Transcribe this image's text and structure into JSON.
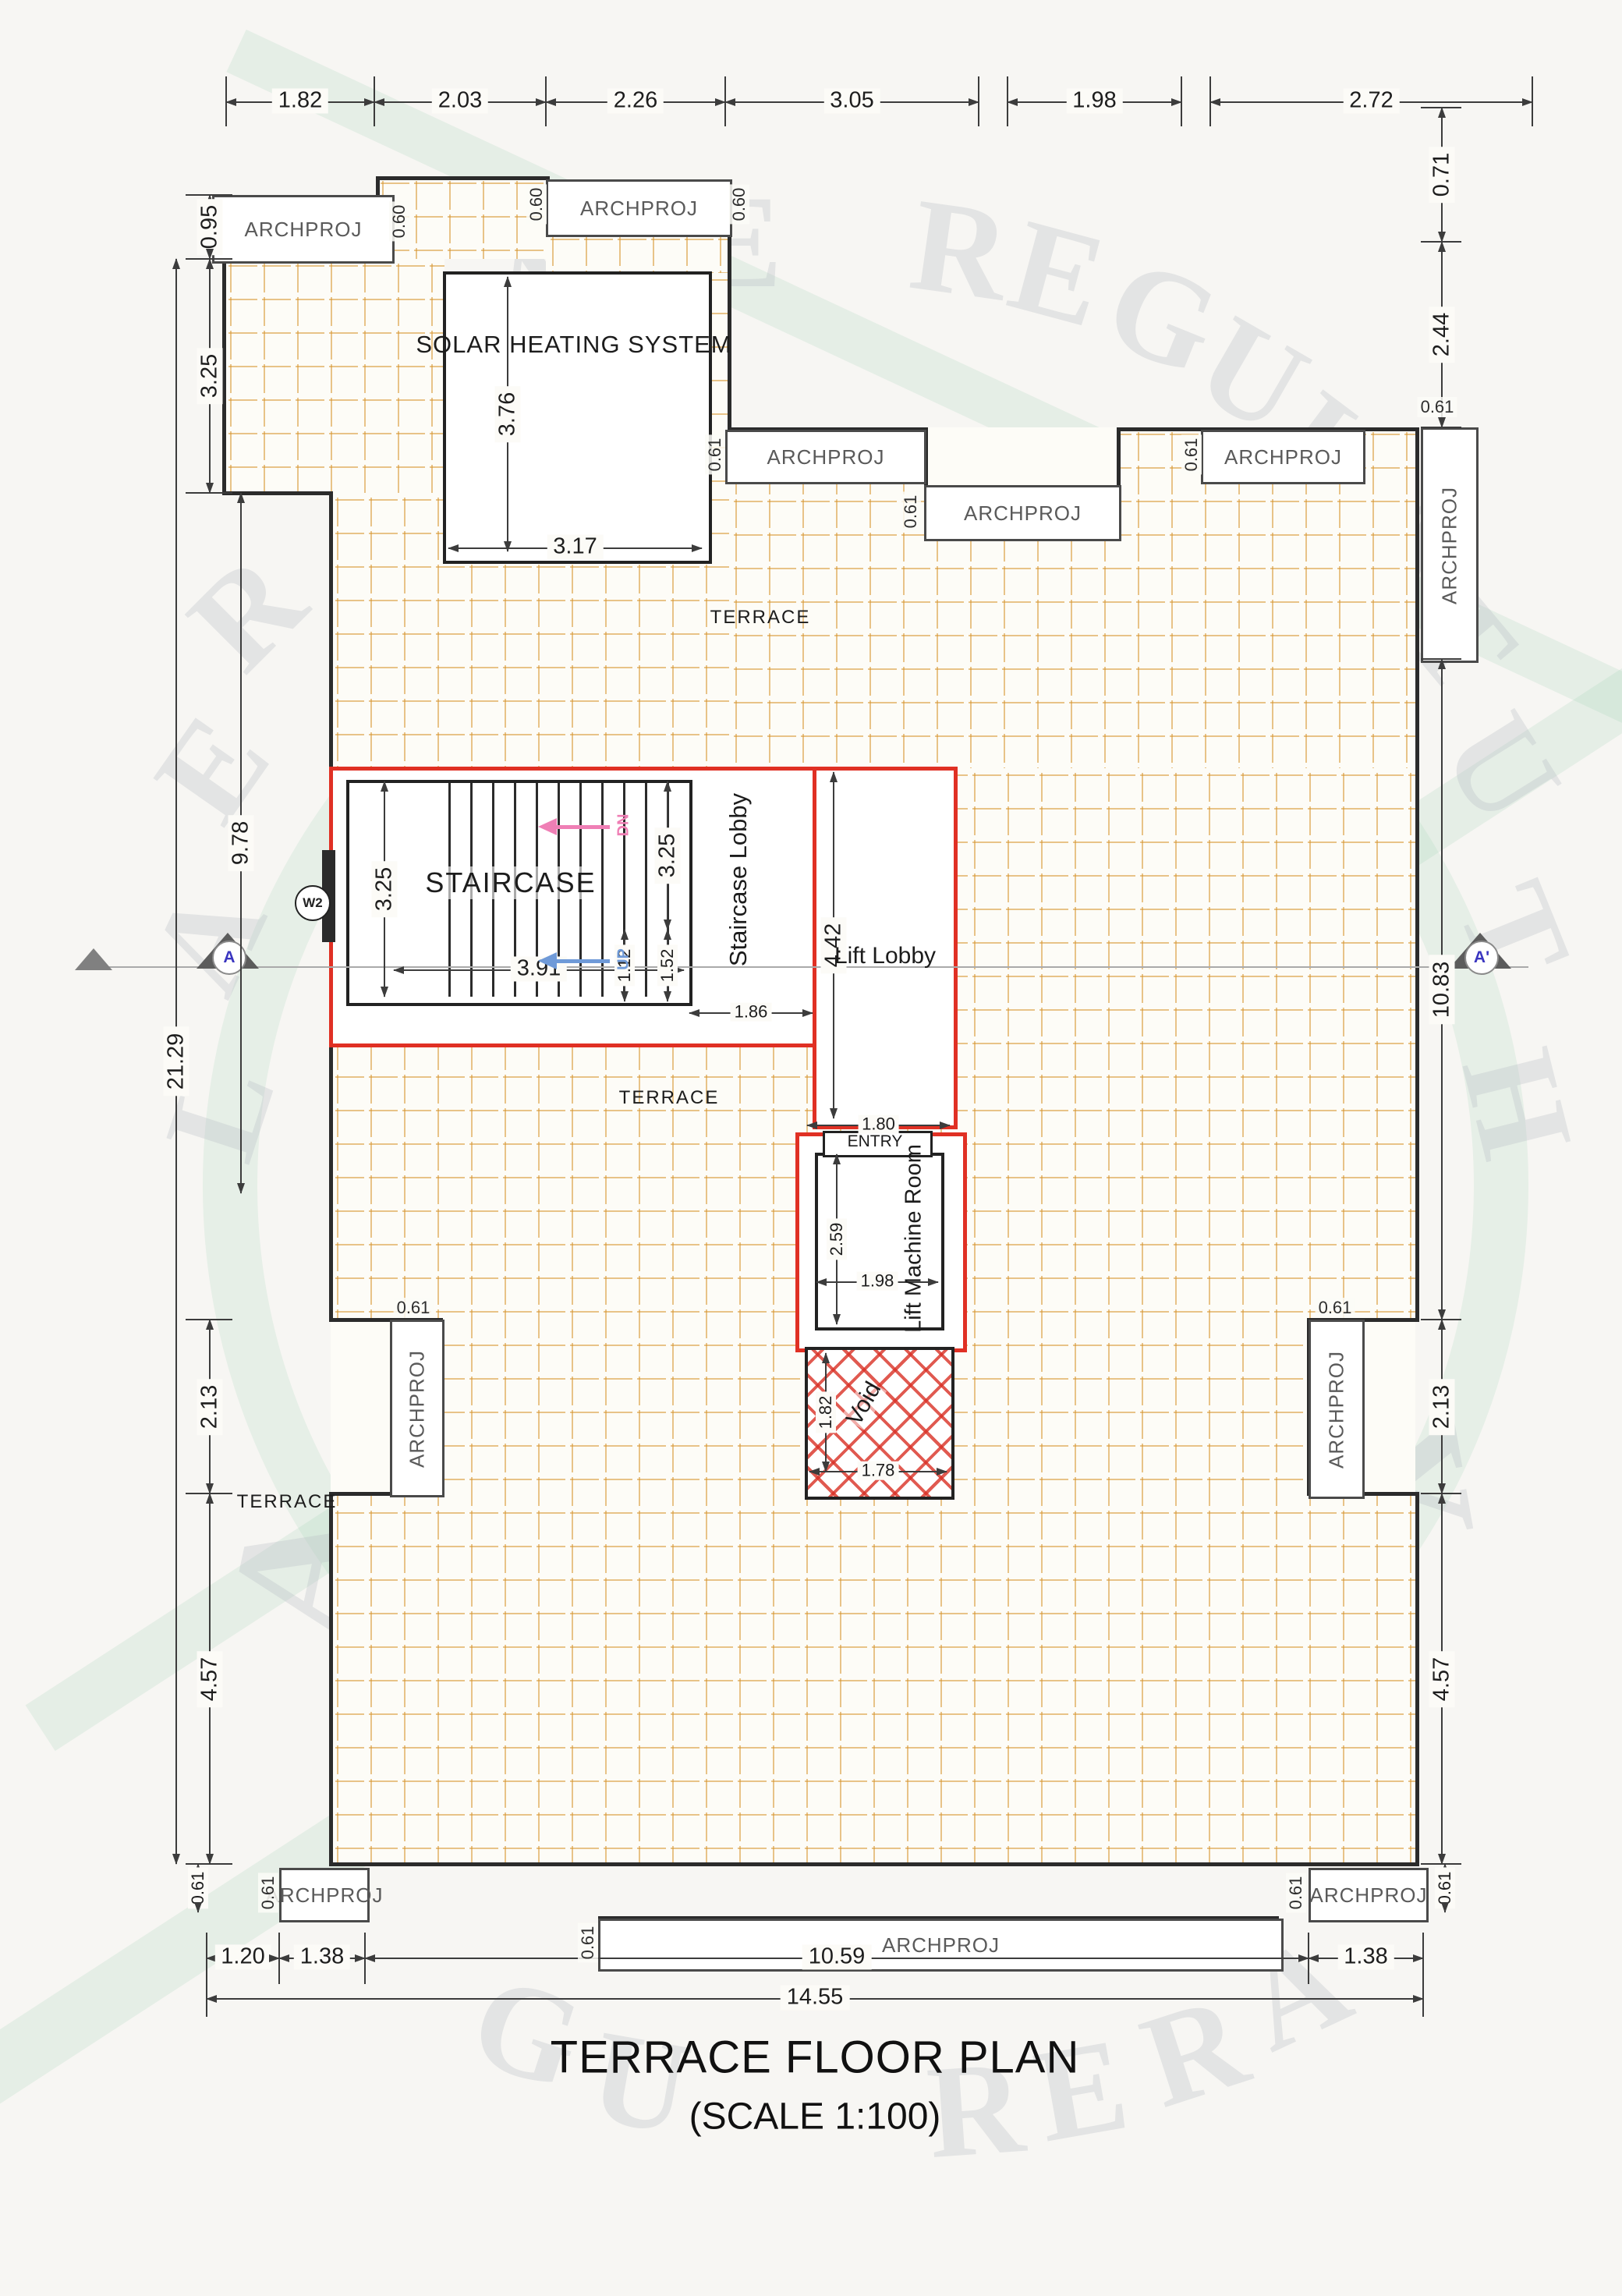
{
  "title": {
    "main": "TERRACE FLOOR PLAN",
    "scale": "(SCALE 1:100)"
  },
  "rooms": {
    "solar": "SOLAR HEATING SYSTEM",
    "staircase": "STAIRCASE",
    "staircase_lobby": "Staircase Lobby",
    "lift_lobby": "Lift Lobby",
    "lift_machine_room": "Lift Machine Room",
    "entry": "ENTRY",
    "void_label": "Void",
    "terrace": "TERRACE"
  },
  "labels": {
    "archproj": "ARCHPROJ",
    "up": "UP",
    "dn": "DN",
    "w2": "W2",
    "section_a": "A",
    "section_a_prime": "A'"
  },
  "dims": {
    "top": [
      "1.82",
      "2.03",
      "2.26",
      "3.05",
      "1.98",
      "2.72"
    ],
    "left": {
      "v095": "0.95",
      "v325": "3.25",
      "v978": "9.78",
      "v2129": "21.29",
      "v213": "2.13",
      "v457": "4.57",
      "v061": "0.61"
    },
    "right": {
      "v071": "0.71",
      "v244": "2.44",
      "c061": "0.61",
      "v1083": "10.83",
      "v213": "2.13",
      "v457": "4.57",
      "v061": "0.61"
    },
    "bottom": {
      "v120": "1.20",
      "v138a": "1.38",
      "v1059": "10.59",
      "v1455": "14.55",
      "v138b": "1.38"
    },
    "solar": {
      "h376": "3.76",
      "w317": "3.17"
    },
    "stair": {
      "v325a": "3.25",
      "w391": "3.91",
      "v325b": "3.25",
      "v152": "1.52",
      "v112": "1.12",
      "w186": "1.86"
    },
    "lift": {
      "v442": "4.42",
      "w180": "1.80",
      "v259": "2.59",
      "w198": "1.98"
    },
    "void": {
      "v182": "1.82",
      "w178": "1.78"
    },
    "p060": "0.60",
    "p061": "0.61"
  },
  "watermark": {
    "letters": [
      "S",
      "T",
      "A",
      "T",
      "E",
      "R",
      "E",
      "G",
      "U",
      "L",
      "A",
      "T",
      "R",
      "E",
      "A",
      "L",
      "U",
      "T",
      "H",
      "G",
      "U",
      "R",
      "E",
      "R",
      "A",
      "R",
      "A",
      "Y"
    ]
  }
}
